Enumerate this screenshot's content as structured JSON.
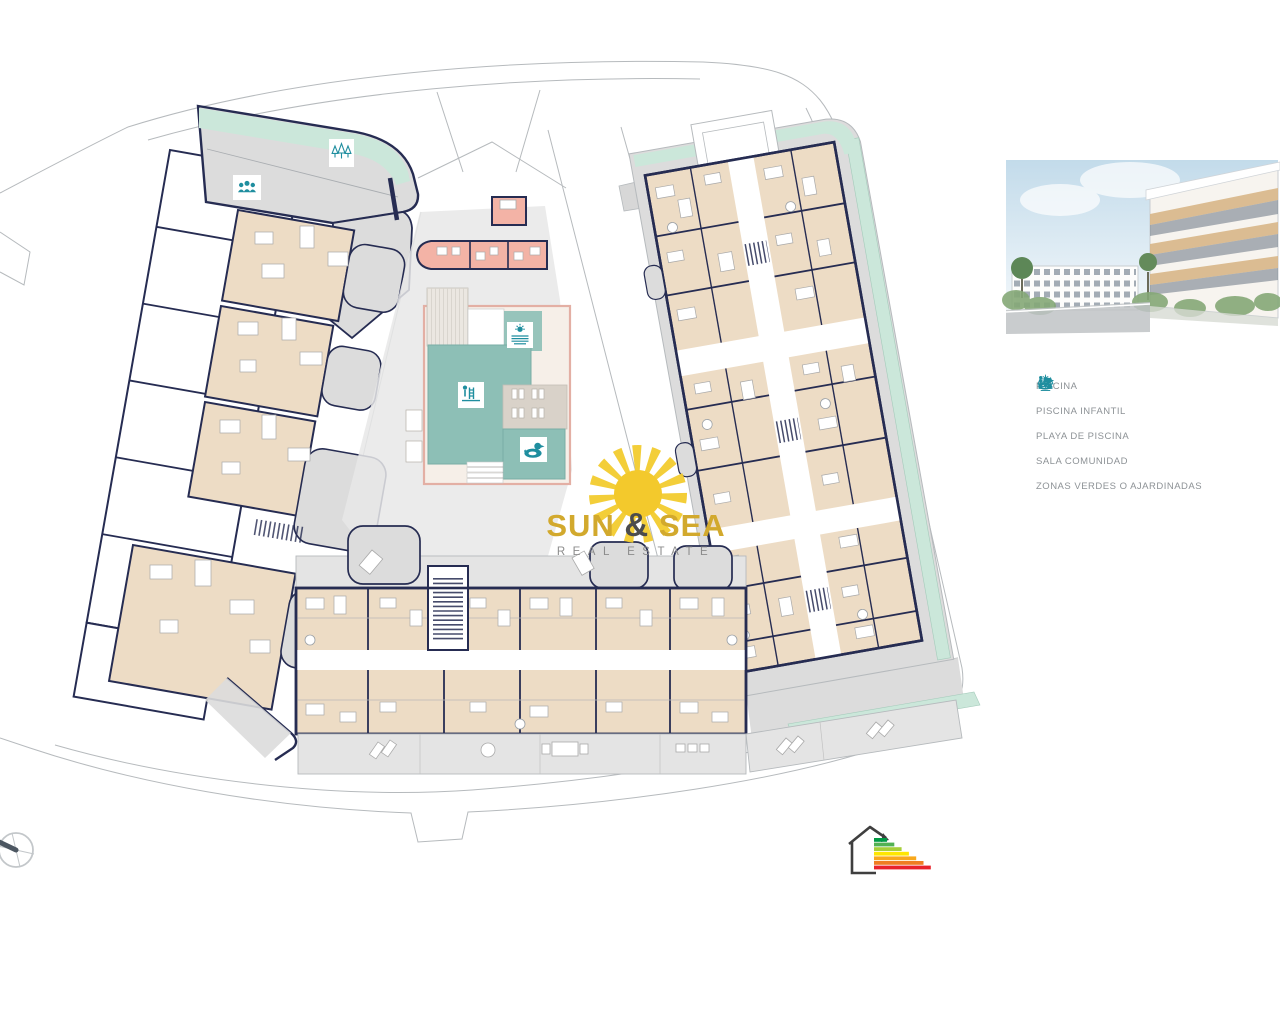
{
  "watermark": {
    "word1": "SUN",
    "ampersand": "&",
    "word2": "SEA",
    "subtitle": "REAL ESTATE"
  },
  "legend": {
    "items": [
      {
        "icon": "pool-ladder-icon",
        "label": "PISCINA"
      },
      {
        "icon": "duck-float-icon",
        "label": "PISCINA INFANTIL"
      },
      {
        "icon": "sun-waves-icon",
        "label": "PLAYA DE PISCINA"
      },
      {
        "icon": "people-group-icon",
        "label": "SALA COMUNIDAD"
      },
      {
        "icon": "trees-icon",
        "label": "ZONAS VERDES O AJARDINADAS"
      }
    ]
  },
  "plan_markers": {
    "left_block": [
      "trees-icon",
      "people-group-icon"
    ],
    "pool_area": [
      "sun-waves-icon",
      "pool-ladder-icon",
      "duck-float-icon"
    ]
  },
  "colors": {
    "legend-icon": "#1f8e9f",
    "legend-text": "#8d9296",
    "gold": "#d2a92d",
    "amp": "#4c4c4c",
    "subtitle": "#8c8c8c",
    "wall-navy": "#262c52",
    "room-beige": "#eddcc5",
    "common-gray": "#dcdcdc",
    "green-strip": "#cbe7da",
    "pool-teal": "#8dbfb6",
    "pink-room": "#f3b3a6",
    "boundary": "#b6babd",
    "watermark-sun": "#f2cb2e"
  },
  "energy_rating": {
    "bar_colors": [
      "#009a44",
      "#52b153",
      "#a6ce39",
      "#ffe600",
      "#f8a81c",
      "#ef7d22",
      "#e8232b"
    ]
  }
}
